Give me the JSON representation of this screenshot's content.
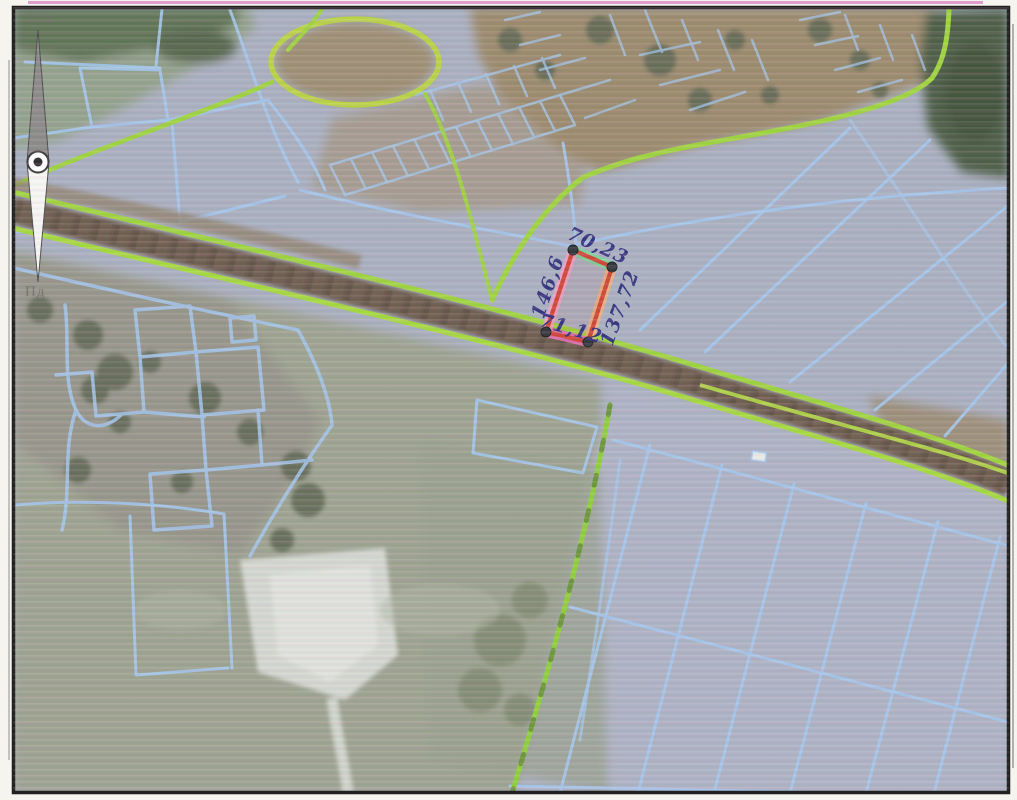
{
  "compass": {
    "north_label": "ПН",
    "south_label": "Пд"
  },
  "parcel": {
    "measurements": {
      "top": "70,23",
      "right": "137,72",
      "bottom": "71,12",
      "left": "146,6"
    }
  },
  "theme": {
    "paper": "#f6f4ef",
    "border": "#1f1f1f",
    "base-field": "#a9b0bf",
    "cadastral-blue": "#a4c8ec",
    "boundary-green": "#9ed43e",
    "corridor-brown": "#6d5e50",
    "village-brown": "#9b8b6d",
    "forest-dark": "#4d5e46",
    "field-green-gray": "#9da390",
    "white-patch": "#d6dad4",
    "parcel-red": "#cf4636",
    "hl-pink": "#f79fc7",
    "hl-magenta": "#f470bd",
    "hl-orange": "#f6b273",
    "hl-green": "#74dc95",
    "vertex-dark": "#33383b",
    "annotation-ink": "#34347f",
    "compass-gray": "#8a8a88",
    "compass-label": "#6d6d66"
  }
}
